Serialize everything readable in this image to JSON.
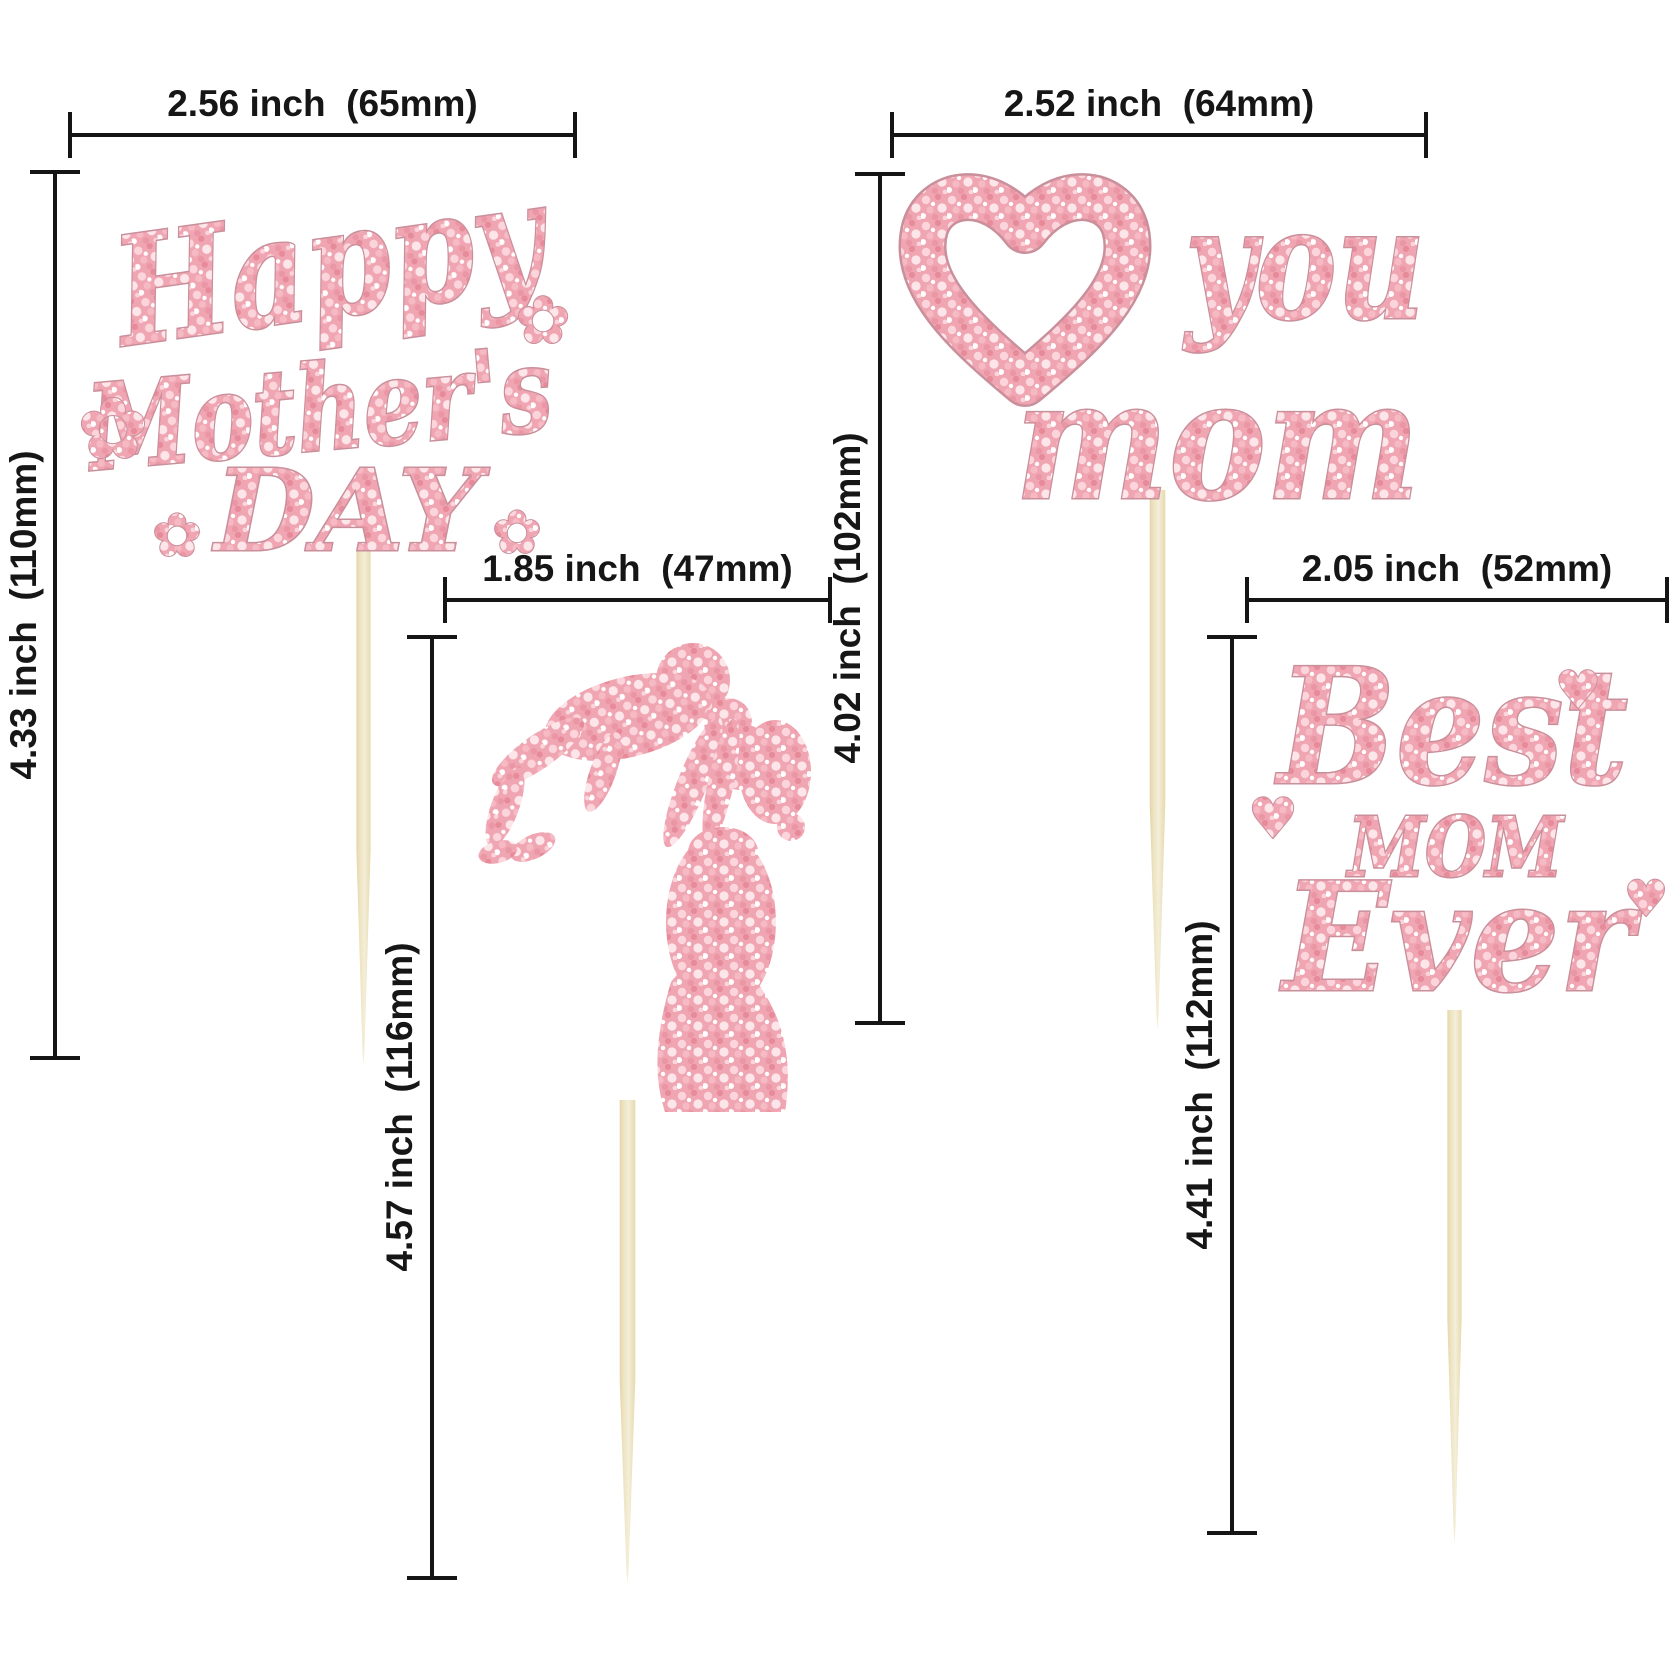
{
  "colors": {
    "background": "#ffffff",
    "glitter_pink_base": "#f0a6b2",
    "glitter_pink_light": "#fbd5db",
    "glitter_pink_dark": "#e78b9b",
    "glitter_outline": "#c98f9b",
    "stick_wood": "#ece2bd",
    "dimension_line": "#151515"
  },
  "toppers": {
    "happy_mothers_day": {
      "line1": "Happy",
      "line2": "Mother's",
      "line3": "DAY",
      "flower_glyph": "✿",
      "width_label": "2.56 inch  (65mm)",
      "height_label": "4.33 inch  (110mm)"
    },
    "mother_child": {
      "width_label": "1.85 inch  (47mm)",
      "height_label": "4.57 inch  (116mm)"
    },
    "love_you_mom": {
      "heart_glyph": "♥",
      "word1": "you",
      "word2": "mom",
      "width_label": "2.52 inch  (64mm)",
      "height_label": "4.02 inch  (102mm)"
    },
    "best_mom_ever": {
      "word1": "Best",
      "word2": "MOM",
      "word3": "Ever",
      "heart_glyph": "♥",
      "width_label": "2.05 inch  (52mm)",
      "height_label": "4.41 inch  (112mm)"
    }
  }
}
